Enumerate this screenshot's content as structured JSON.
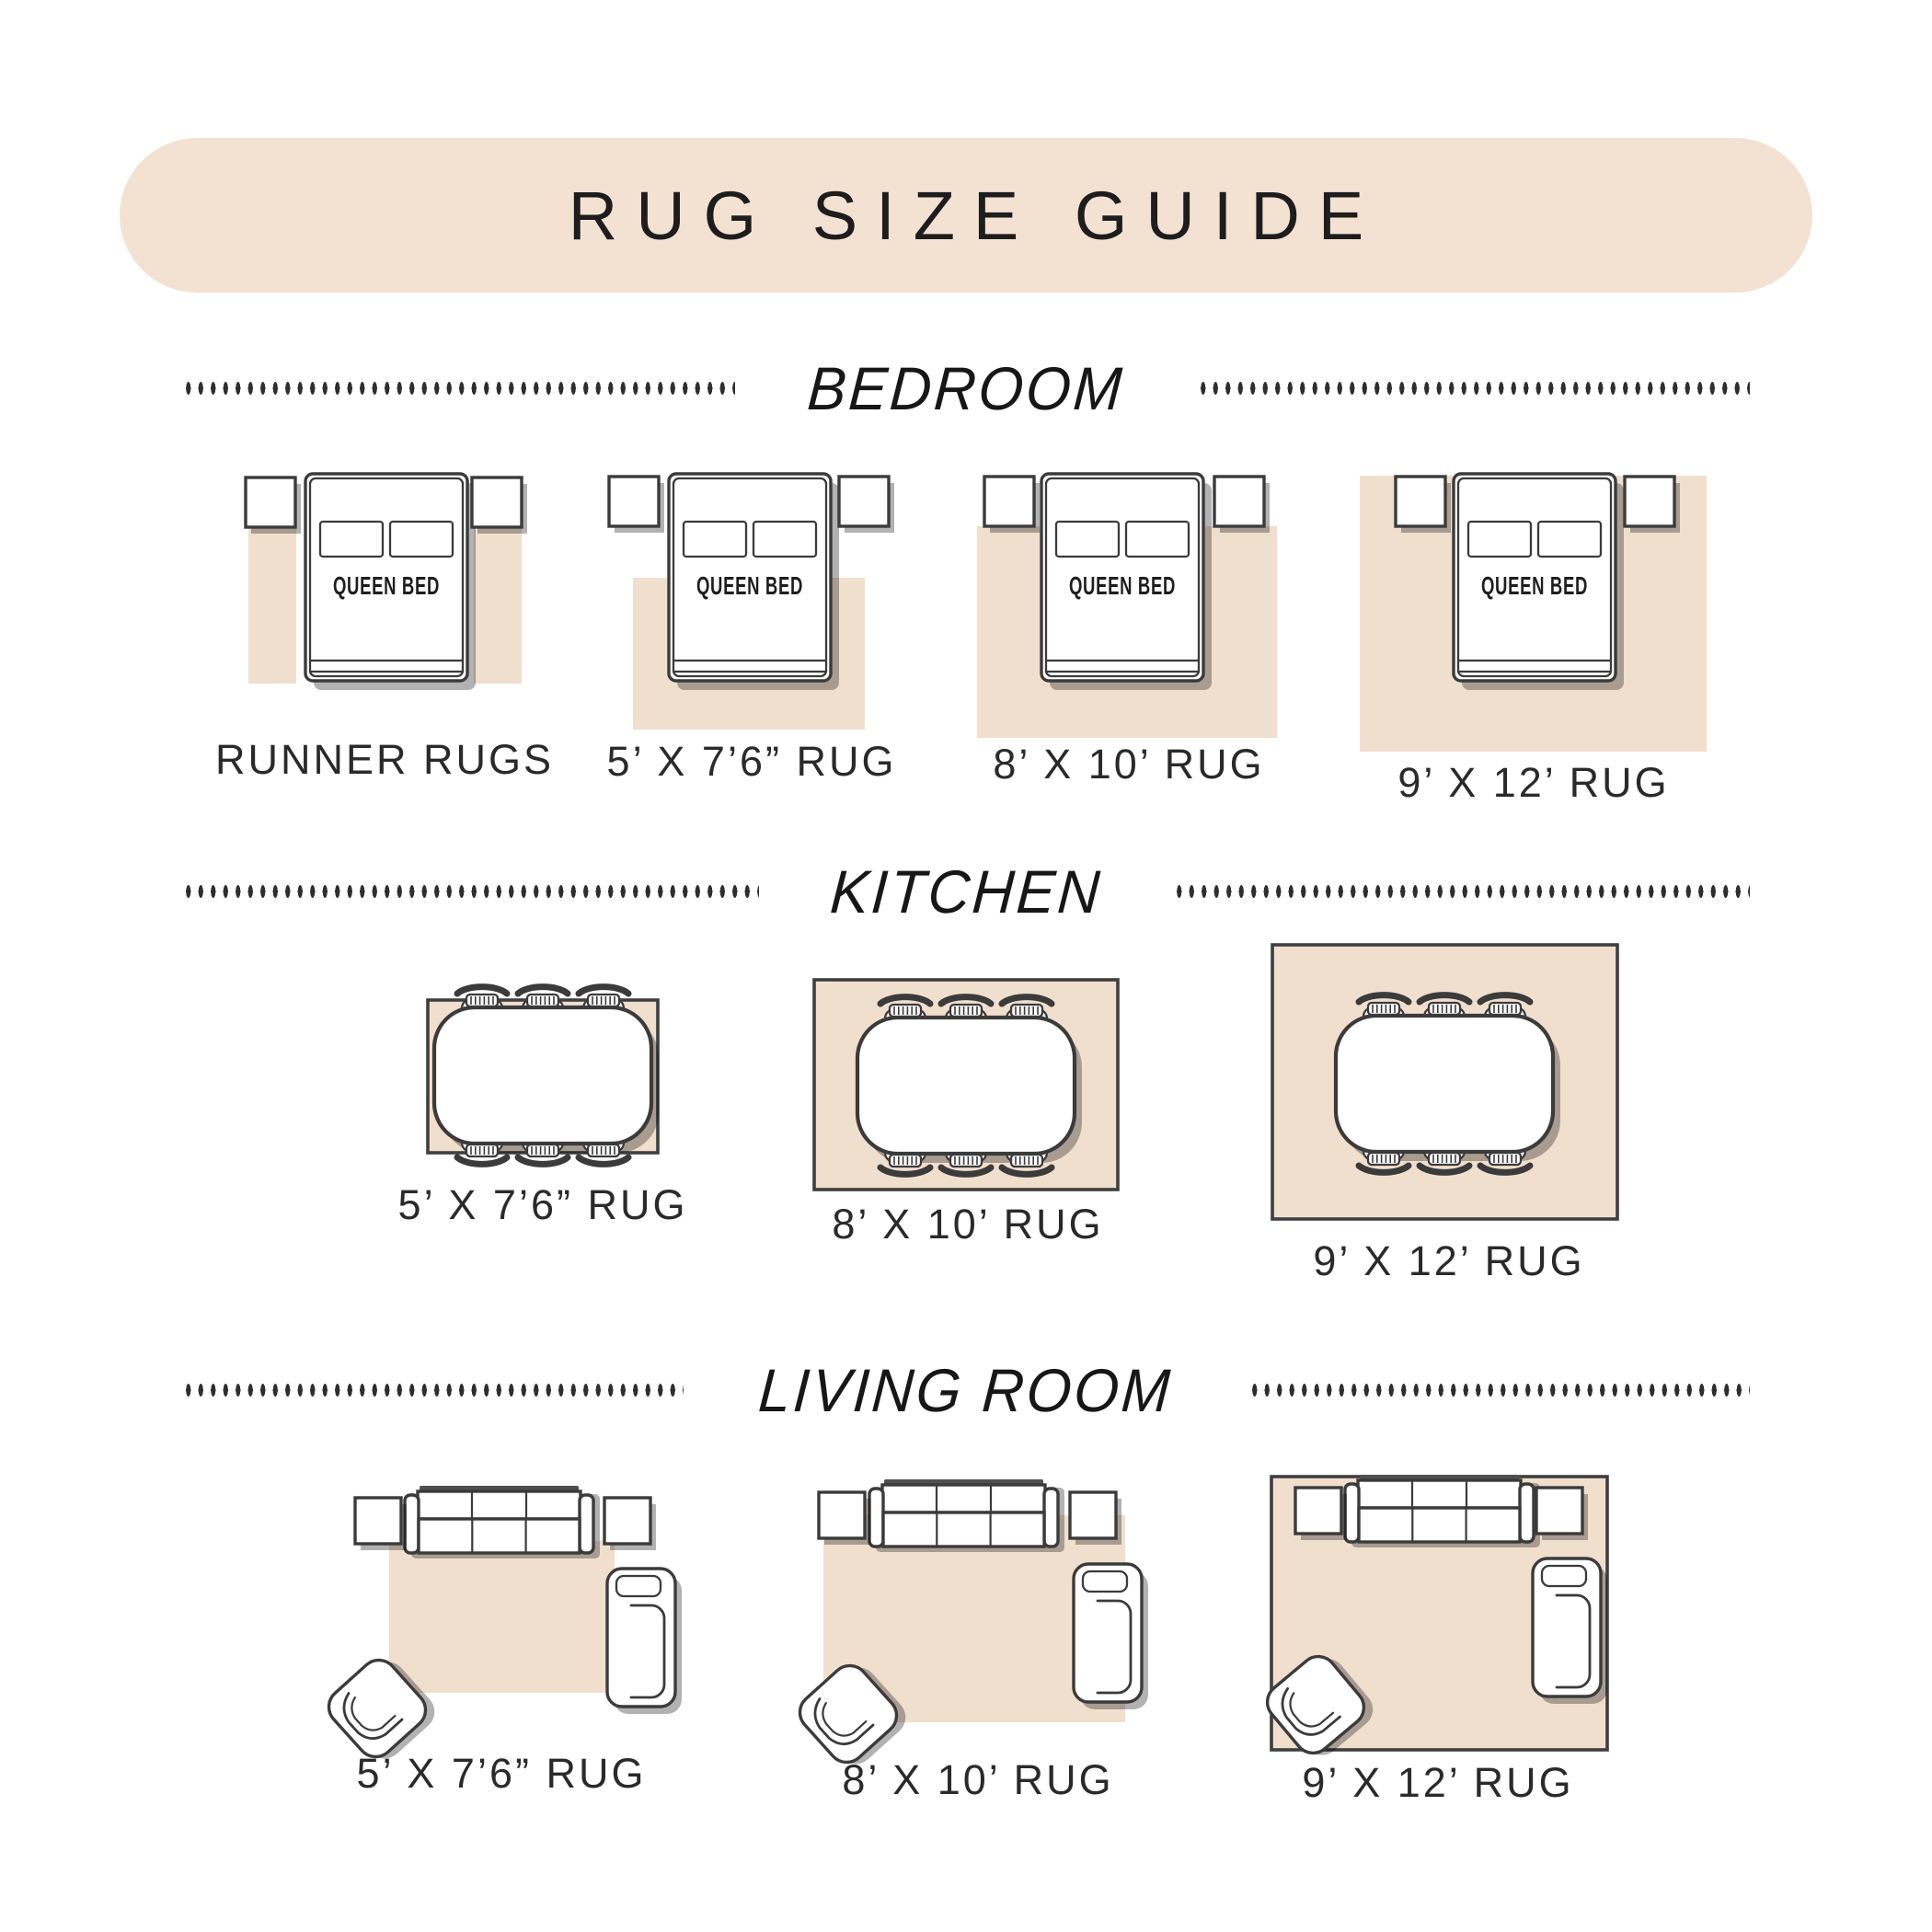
{
  "title": "RUG SIZE GUIDE",
  "bed_label": "QUEEN BED",
  "sections": [
    {
      "title": "BEDROOM",
      "tiles": [
        {
          "furniture": "queen-bed-with-nightstands",
          "rug": "runner",
          "label": "RUNNER RUGS"
        },
        {
          "furniture": "queen-bed-with-nightstands",
          "rug": "5x7-6",
          "label": "5’ X 7’6” RUG"
        },
        {
          "furniture": "queen-bed-with-nightstands",
          "rug": "8x10",
          "label": "8’ X 10’ RUG"
        },
        {
          "furniture": "queen-bed-with-nightstands",
          "rug": "9x12",
          "label": "9’ X 12’ RUG"
        }
      ]
    },
    {
      "title": "KITCHEN",
      "tiles": [
        {
          "furniture": "dining-table-six-chairs",
          "rug": "5x7-6",
          "label": "5’ X 7’6” RUG"
        },
        {
          "furniture": "dining-table-six-chairs",
          "rug": "8x10",
          "label": "8’ X 10’ RUG"
        },
        {
          "furniture": "dining-table-six-chairs",
          "rug": "9x12",
          "label": "9’ X 12’ RUG"
        }
      ]
    },
    {
      "title": "LIVING ROOM",
      "tiles": [
        {
          "furniture": "sofa-side-tables-chaise-accent-chair",
          "rug": "5x7-6",
          "label": "5’ X 7’6” RUG"
        },
        {
          "furniture": "sofa-side-tables-chaise-accent-chair",
          "rug": "8x10",
          "label": "8’ X 10’ RUG"
        },
        {
          "furniture": "sofa-side-tables-chaise-accent-chair",
          "rug": "9x12",
          "label": "9’ X 12’ RUG"
        }
      ]
    }
  ],
  "colors": {
    "banner_bg": "#f3e2d2",
    "rug": "#f1dfce",
    "outline": "#3b3b3b",
    "title_text": "#1d1d1d",
    "label_text": "#2a2a2a"
  }
}
